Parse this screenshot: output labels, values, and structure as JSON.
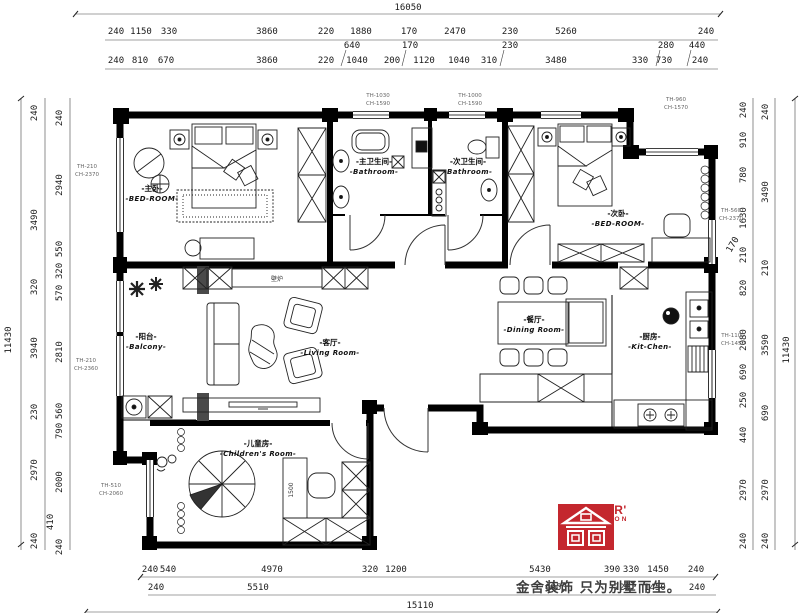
{
  "dims": {
    "top": {
      "total": "16050",
      "row2": [
        "240",
        "1150",
        "330",
        "3860",
        "220",
        "1880",
        "170",
        "2470",
        "230",
        "5260",
        "240"
      ],
      "leaders": [
        "640",
        "170",
        "230",
        "280",
        "440"
      ],
      "row3": [
        "240",
        "810",
        "670",
        "3860",
        "220",
        "1040",
        "200",
        "1120",
        "1040",
        "310",
        "3480",
        "330",
        "730",
        "240"
      ]
    },
    "left": {
      "total": "11430",
      "mid": [
        "240",
        "3490",
        "320",
        "3940",
        "230",
        "2970",
        "240"
      ],
      "leader": "410",
      "inner": [
        "240",
        "2940",
        "550",
        "320",
        "570",
        "2810",
        "560",
        "790",
        "2000",
        "240"
      ]
    },
    "right": {
      "total": "11430",
      "mid": [
        "240",
        "3490",
        "210",
        "3590",
        "690",
        "2970",
        "240"
      ],
      "leader": "170",
      "inner": [
        "240",
        "910",
        "780",
        "1630",
        "210",
        "820",
        "2080",
        "690",
        "250",
        "440",
        "2970",
        "240"
      ]
    },
    "bottom": {
      "total": "15110",
      "row1": [
        "240",
        "540",
        "4970",
        "320",
        "1200",
        "5430",
        "390",
        "330",
        "1450",
        "240"
      ],
      "row2": [
        "240",
        "5510",
        "6950",
        "720",
        "1450",
        "240"
      ]
    }
  },
  "rooms": {
    "master_bedroom": {
      "cn": "-主卧-",
      "en": "-BED-ROOM-"
    },
    "master_bath": {
      "cn": "-主卫生间-",
      "en": "-Bathroom-"
    },
    "second_bath": {
      "cn": "-次卫生间-",
      "en": "-Bathroom-"
    },
    "second_bedroom": {
      "cn": "-次卧-",
      "en": "-BED-ROOM-"
    },
    "balcony": {
      "cn": "-阳台-",
      "en": "-Balcony-"
    },
    "living_room": {
      "cn": "-客厅-",
      "en": "-Living Room-"
    },
    "dining_room": {
      "cn": "-餐厅-",
      "en": "-Dining Room-"
    },
    "kitchen": {
      "cn": "-厨房-",
      "en": "-Kit-Chen-"
    },
    "children_room": {
      "cn": "-儿童房-",
      "en": "-Children's Room-"
    },
    "fireplace": "壁炉"
  },
  "annotations": {
    "bath1": {
      "l1": "TH-1030",
      "l2": "CH-1590"
    },
    "bath2": {
      "l1": "TH-1000",
      "l2": "CH-1590"
    },
    "right_top": {
      "l1": "TH-960",
      "l2": "CH-1570"
    },
    "left_upper": {
      "l1": "TH-210",
      "l2": "CH-2370"
    },
    "left_lower": {
      "l1": "TH-210",
      "l2": "CH-2360"
    },
    "left_bottom": {
      "l1": "TH-510",
      "l2": "CH-2060"
    },
    "right_mid": {
      "l1": "TH-560",
      "l2": "CH-2370"
    },
    "right_kitchen": {
      "l1": "TH-1100",
      "l2": "CH-1450"
    },
    "desk_width": "1500"
  },
  "logo": {
    "brand": "KINGSER'",
    "sub": "DECORATION",
    "slogan": "金舍装饰 只为别墅而生。",
    "brand_color": "#c4272e"
  }
}
